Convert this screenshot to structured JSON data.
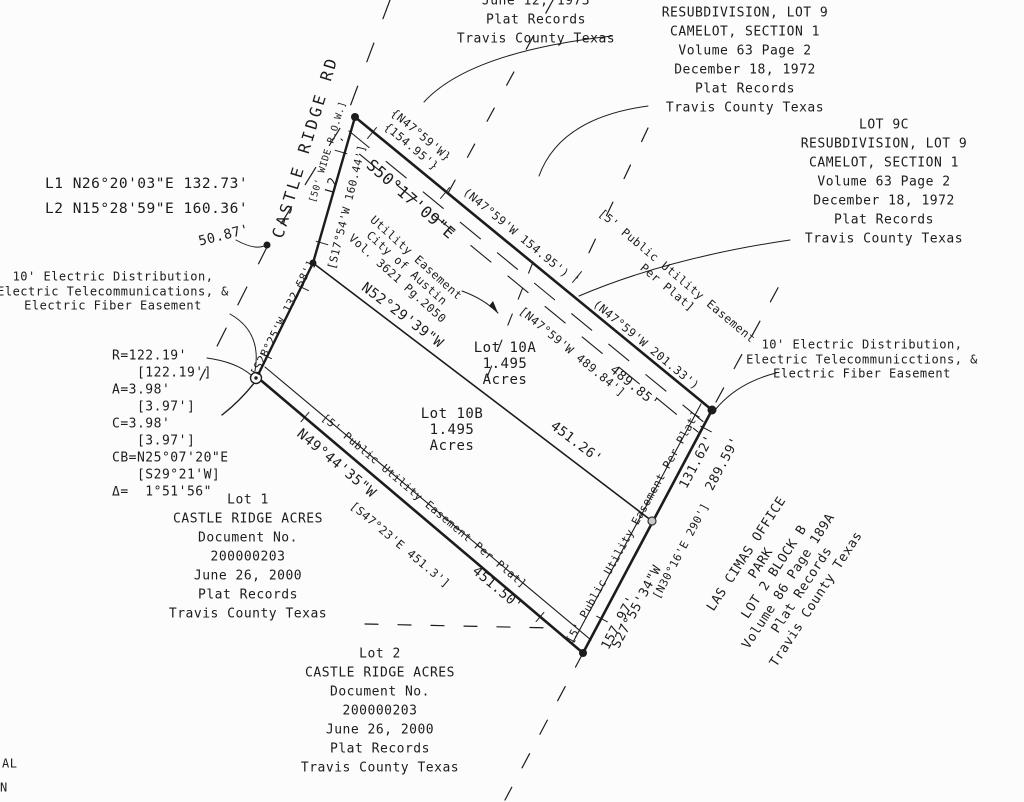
{
  "meta": {
    "paper_color": "#fcfcfc",
    "ink_color": "#1c1c1c",
    "drawing_type": "boundary survey plat"
  },
  "blocks": {
    "top_plat": [
      "June 12, 1973",
      "Plat Records",
      "Travis County Texas"
    ],
    "lot9b": [
      "LOT 9B",
      "RESUBDIVISION, LOT 9",
      "CAMELOT, SECTION 1",
      "Volume 63 Page 2",
      "December 18, 1972",
      "Plat Records",
      "Travis County Texas"
    ],
    "lot9c": [
      "LOT 9C",
      "RESUBDIVISION, LOT 9",
      "CAMELOT, SECTION 1",
      "Volume 63 Page 2",
      "December 18, 1972",
      "Plat Records",
      "Travis County Texas"
    ],
    "line_table": [
      "L1 N26°20'03\"E 132.73'",
      "L2 N15°28'59\"E 160.36'"
    ],
    "electric_left": [
      "10' Electric Distribution,",
      "Electric Telecommunications, &",
      "Electric Fiber Easement"
    ],
    "electric_right": [
      "10' Electric Distribution,",
      "Electric Telecommunicctions, &",
      "Electric Fiber Easement"
    ],
    "curve_data": [
      "R=122.19'",
      "   [122.19']",
      "A=3.98'",
      "   [3.97']",
      "C=3.98'",
      "   [3.97']",
      "CB=N25°07'20\"E",
      "   [S29°21'W]",
      "Δ=  1°51'56\""
    ],
    "lot1": [
      "Lot 1",
      "CASTLE RIDGE ACRES",
      "Document No.",
      "200000203",
      "June 26, 2000",
      "Plat Records",
      "Travis County Texas"
    ],
    "lot2": [
      "Lot 2",
      "CASTLE RIDGE ACRES",
      "Document No.",
      "200000203",
      "June 26, 2000",
      "Plat Records",
      "Travis County Texas"
    ],
    "lot10a": [
      "Lot 10A",
      "1.495",
      "Acres"
    ],
    "lot10b": [
      "Lot 10B",
      "1.495",
      "Acres"
    ],
    "brace_call": [
      "{N47°59'W}",
      "{154.95'}"
    ],
    "pue_top": [
      "[5' Public Utility Easement",
      "Per Plat]"
    ],
    "city_easement": [
      "Utility Easement",
      "City of Austin",
      "Vol. 3621 Pg.2050"
    ],
    "las_cimas": [
      "LAS CIMAS OFFICE",
      "PARK",
      "LOT 2 BLOCK B",
      "Volume 86 Page 189A",
      "Plat Records",
      "Travis County Texas"
    ]
  },
  "labels": {
    "road_name": "CASTLE RIDGE RD",
    "road_row": "[50' WIDE R.O.W.]",
    "bearing_s5017": "S50°17'09\"E",
    "call_15495": "(N47°59'W 154.95')",
    "call_20133": "(N47°59'W 201.33')",
    "call_48984": "[N47°59'W 489.84']",
    "dist_48985": "489.85'",
    "line_l2": "L2",
    "call_s1754": "[S17°54'W 160.44']",
    "call_s2825": "[S28°25'W 132.58']",
    "bearing_n5229": "N52°29'39\"W",
    "dist_45126": "451.26'",
    "bearing_n4944": "N49°44'35\"W",
    "pue_bottom": "[5' Public Utility Easement Per Plat]",
    "call_s4723": "[S47°23'E 451.3']",
    "dist_45150": "451.50'",
    "pue_right": "[5' Public Utility Easement Per Plat]",
    "dist_15797": "157.97'",
    "bearing_s2755": "S27°55'34\"W",
    "call_n3016": "[N30°16'E 290']",
    "dist_13162": "131.62'",
    "dist_28959": "289.59'",
    "dist_5087": "50.87'",
    "edge_fragment_1": "AL",
    "edge_fragment_2": "N"
  }
}
